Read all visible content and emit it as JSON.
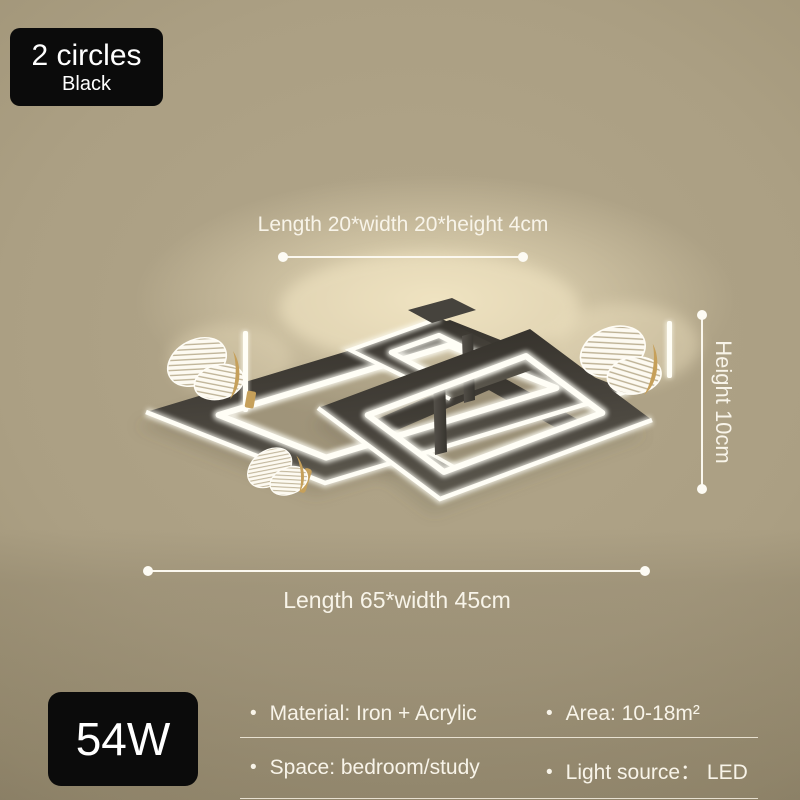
{
  "product": {
    "variant_badge": {
      "title": "2 circles",
      "subtitle": "Black"
    },
    "power_badge": {
      "label": "54W"
    }
  },
  "dimensions": {
    "top_label": "Length 20*width 20*height 4cm",
    "bottom_label": "Length 65*width 45cm",
    "height_label": "Height 10cm"
  },
  "specs": {
    "bullet": "•",
    "items": [
      "Material: Iron + Acrylic",
      "Area: 10-18m²",
      "Space: bedroom/study",
      "Light source： LED"
    ]
  },
  "colors": {
    "background_tan": "#aca084",
    "badge_black": "#0b0b0b",
    "text_white": "#f8f4e9",
    "frame_dark": "#3f3c35",
    "led_white": "#fffef6",
    "butterfly_gold": "#c6a05a",
    "glow_cream": "#f4e7c3"
  }
}
